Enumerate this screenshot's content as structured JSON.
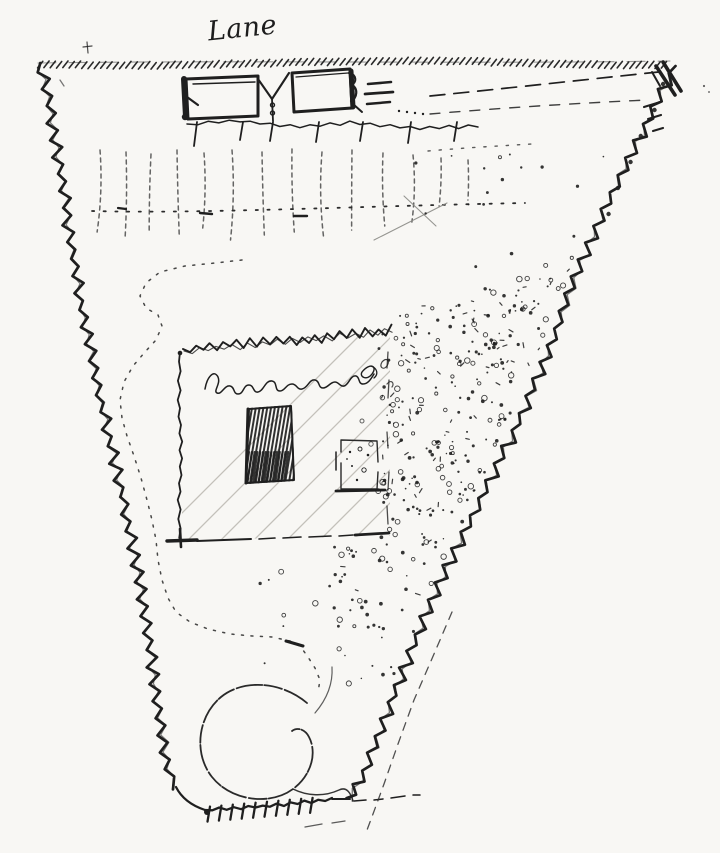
{
  "document": {
    "type": "hand-drawn pen sketch plan",
    "description": "Ink sketch plan of a funnel-shaped (tapering) plot of land, bordered by a lane along the top and narrowing to a small entrance at the bottom"
  },
  "labels": {
    "lane": "Lane",
    "enclosure_note": "Pond enclosed",
    "enclosure_note_legibility": "handwritten scrawl, largely illegible; best-guess transcription"
  },
  "features": [
    {
      "name": "lane-boundary",
      "desc": "hatched line along the top representing the lane frontage"
    },
    {
      "name": "roadside-buildings",
      "desc": "two attached rectangular buildings drawn in heavy ink fronting the lane"
    },
    {
      "name": "fence-with-posts",
      "desc": "fence line with short post ticks below the buildings"
    },
    {
      "name": "planting-row",
      "desc": "row of faint vertical dashed strokes (trees or crops) with a dotted line through it"
    },
    {
      "name": "winding-path",
      "desc": "dotted S-shaped path running down the left side toward a circular loop"
    },
    {
      "name": "hedged-enclosure",
      "desc": "rectangle with scribbled hedge on top, light diagonal hatching, handwritten note, a dark cross-hatched bed and a small stippled plot"
    },
    {
      "name": "stippled-ground",
      "desc": "dense dotted (gravel/orchard) texture filling the right side of the plot"
    },
    {
      "name": "circular-loop",
      "desc": "circular sweep of path near the bottom of the plot"
    },
    {
      "name": "zigzag-boundaries",
      "desc": "wavy zigzag hedge lines forming the left and right plot edges, meeting a short toothed bottom edge"
    },
    {
      "name": "corner-gate",
      "desc": "heavy double stroke gate mark at the top-right corner"
    }
  ],
  "colors": {
    "ink": "#1f1f1f",
    "paper": "#f8f7f4",
    "light_hatch": "#bdbab4",
    "faint_line": "#8a8a85",
    "soft_ink": "#333333"
  }
}
